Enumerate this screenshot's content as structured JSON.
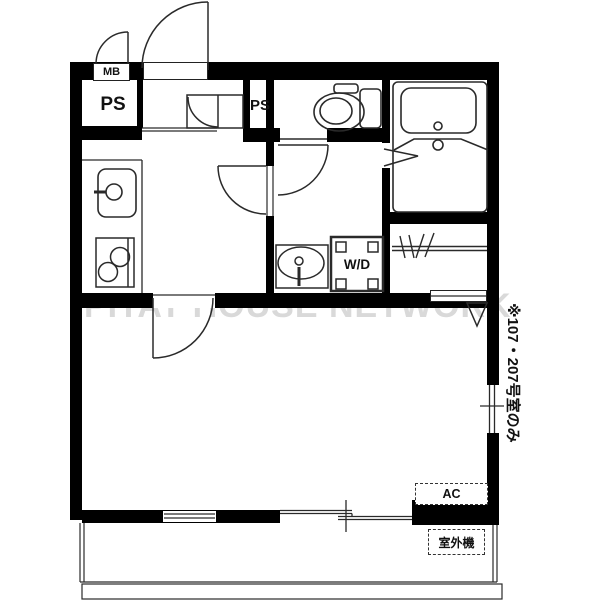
{
  "floorplan": {
    "watermark": "PITAT HOUSE NETWORK",
    "labels": {
      "meter_box": "MB",
      "pipe_space_left": "PS",
      "pipe_space_right": "PS",
      "washer_dryer": "W/D",
      "air_conditioner": "AC",
      "outdoor_unit": "室外機",
      "vertical_note": "※107・207号室のみ"
    },
    "colors": {
      "wall": "#000000",
      "line": "#2a2a2a",
      "watermark": "#d9d9d9",
      "background": "#ffffff"
    }
  }
}
